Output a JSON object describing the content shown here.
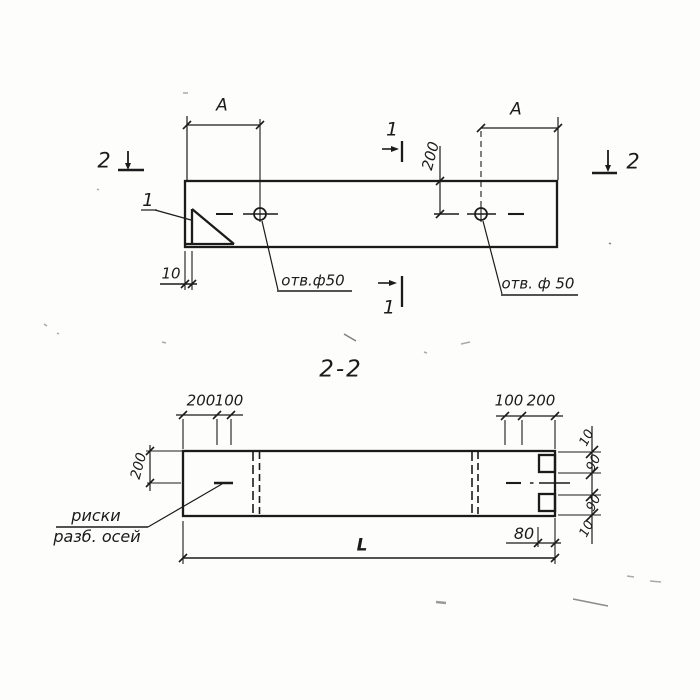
{
  "drawing": {
    "title_block": {
      "section_title": "2-2"
    },
    "top_view": {
      "dim_a_left": "A",
      "dim_a_right": "A",
      "dim_200_vert": "200",
      "dim_10": "10",
      "hole_label_left": "отв.ф50",
      "hole_label_right": "отв. ф 50",
      "detail_ref": "1",
      "section_mark_1": "1",
      "section_mark_2": "2"
    },
    "section_view": {
      "dim_200_top_left": "200",
      "dim_100_top_left": "100",
      "dim_100_top_right": "100",
      "dim_200_top_right": "200",
      "dim_200_left": "200",
      "dim_10_top": "10",
      "dim_90_top": "90",
      "dim_90_bottom": "90",
      "dim_10_bottom": "10",
      "dim_80": "80",
      "dim_length": "L",
      "axes_note_line1": "риски",
      "axes_note_line2": "разб. осей"
    },
    "ink_color": "#1b1b1b",
    "paper_color": "#fdfdfc"
  }
}
